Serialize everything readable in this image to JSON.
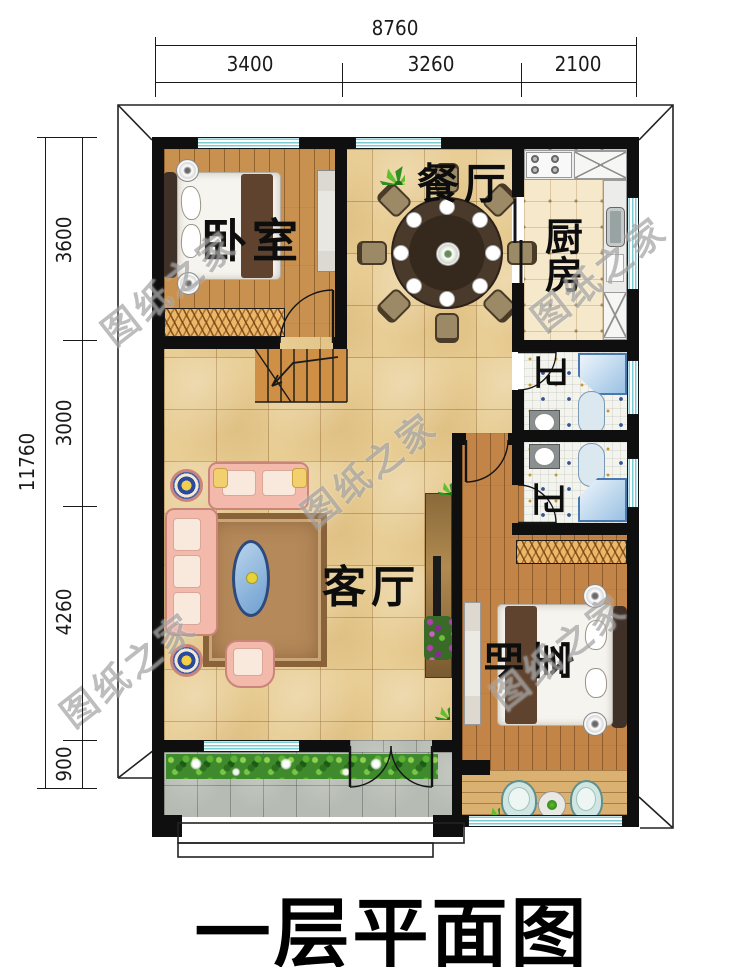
{
  "title": "一层平面图",
  "dimensions": {
    "top": {
      "total": "8760",
      "segments": [
        "3400",
        "3260",
        "2100"
      ]
    },
    "left": {
      "total": "11760",
      "segments": [
        "3600",
        "3000",
        "4260",
        "900"
      ]
    }
  },
  "rooms": {
    "bedroom_top": {
      "label": "卧室"
    },
    "dining": {
      "label": "餐厅"
    },
    "kitchen": {
      "label": "厨房"
    },
    "bath_upper": {
      "label": "卫"
    },
    "bath_lower": {
      "label": "卫"
    },
    "living": {
      "label": "客厅"
    },
    "bedroom_bottom": {
      "label": "卧室",
      "char0": "卧",
      "char1": "室"
    }
  },
  "watermark": {
    "text": "图纸之家"
  },
  "colors": {
    "wall": "#111111",
    "tile_floor": "#e8cd94",
    "wood_floor": "#c9914f",
    "kitchen_floor": "#f6e9cb",
    "bath_floor": "#f4f4ee",
    "porch_floor": "#b6bbb3",
    "window_stripe": "#79ccd3",
    "sofa": "#f3b9ab",
    "hedge": "#3e8a2d",
    "shower": "#9fc4e4"
  }
}
